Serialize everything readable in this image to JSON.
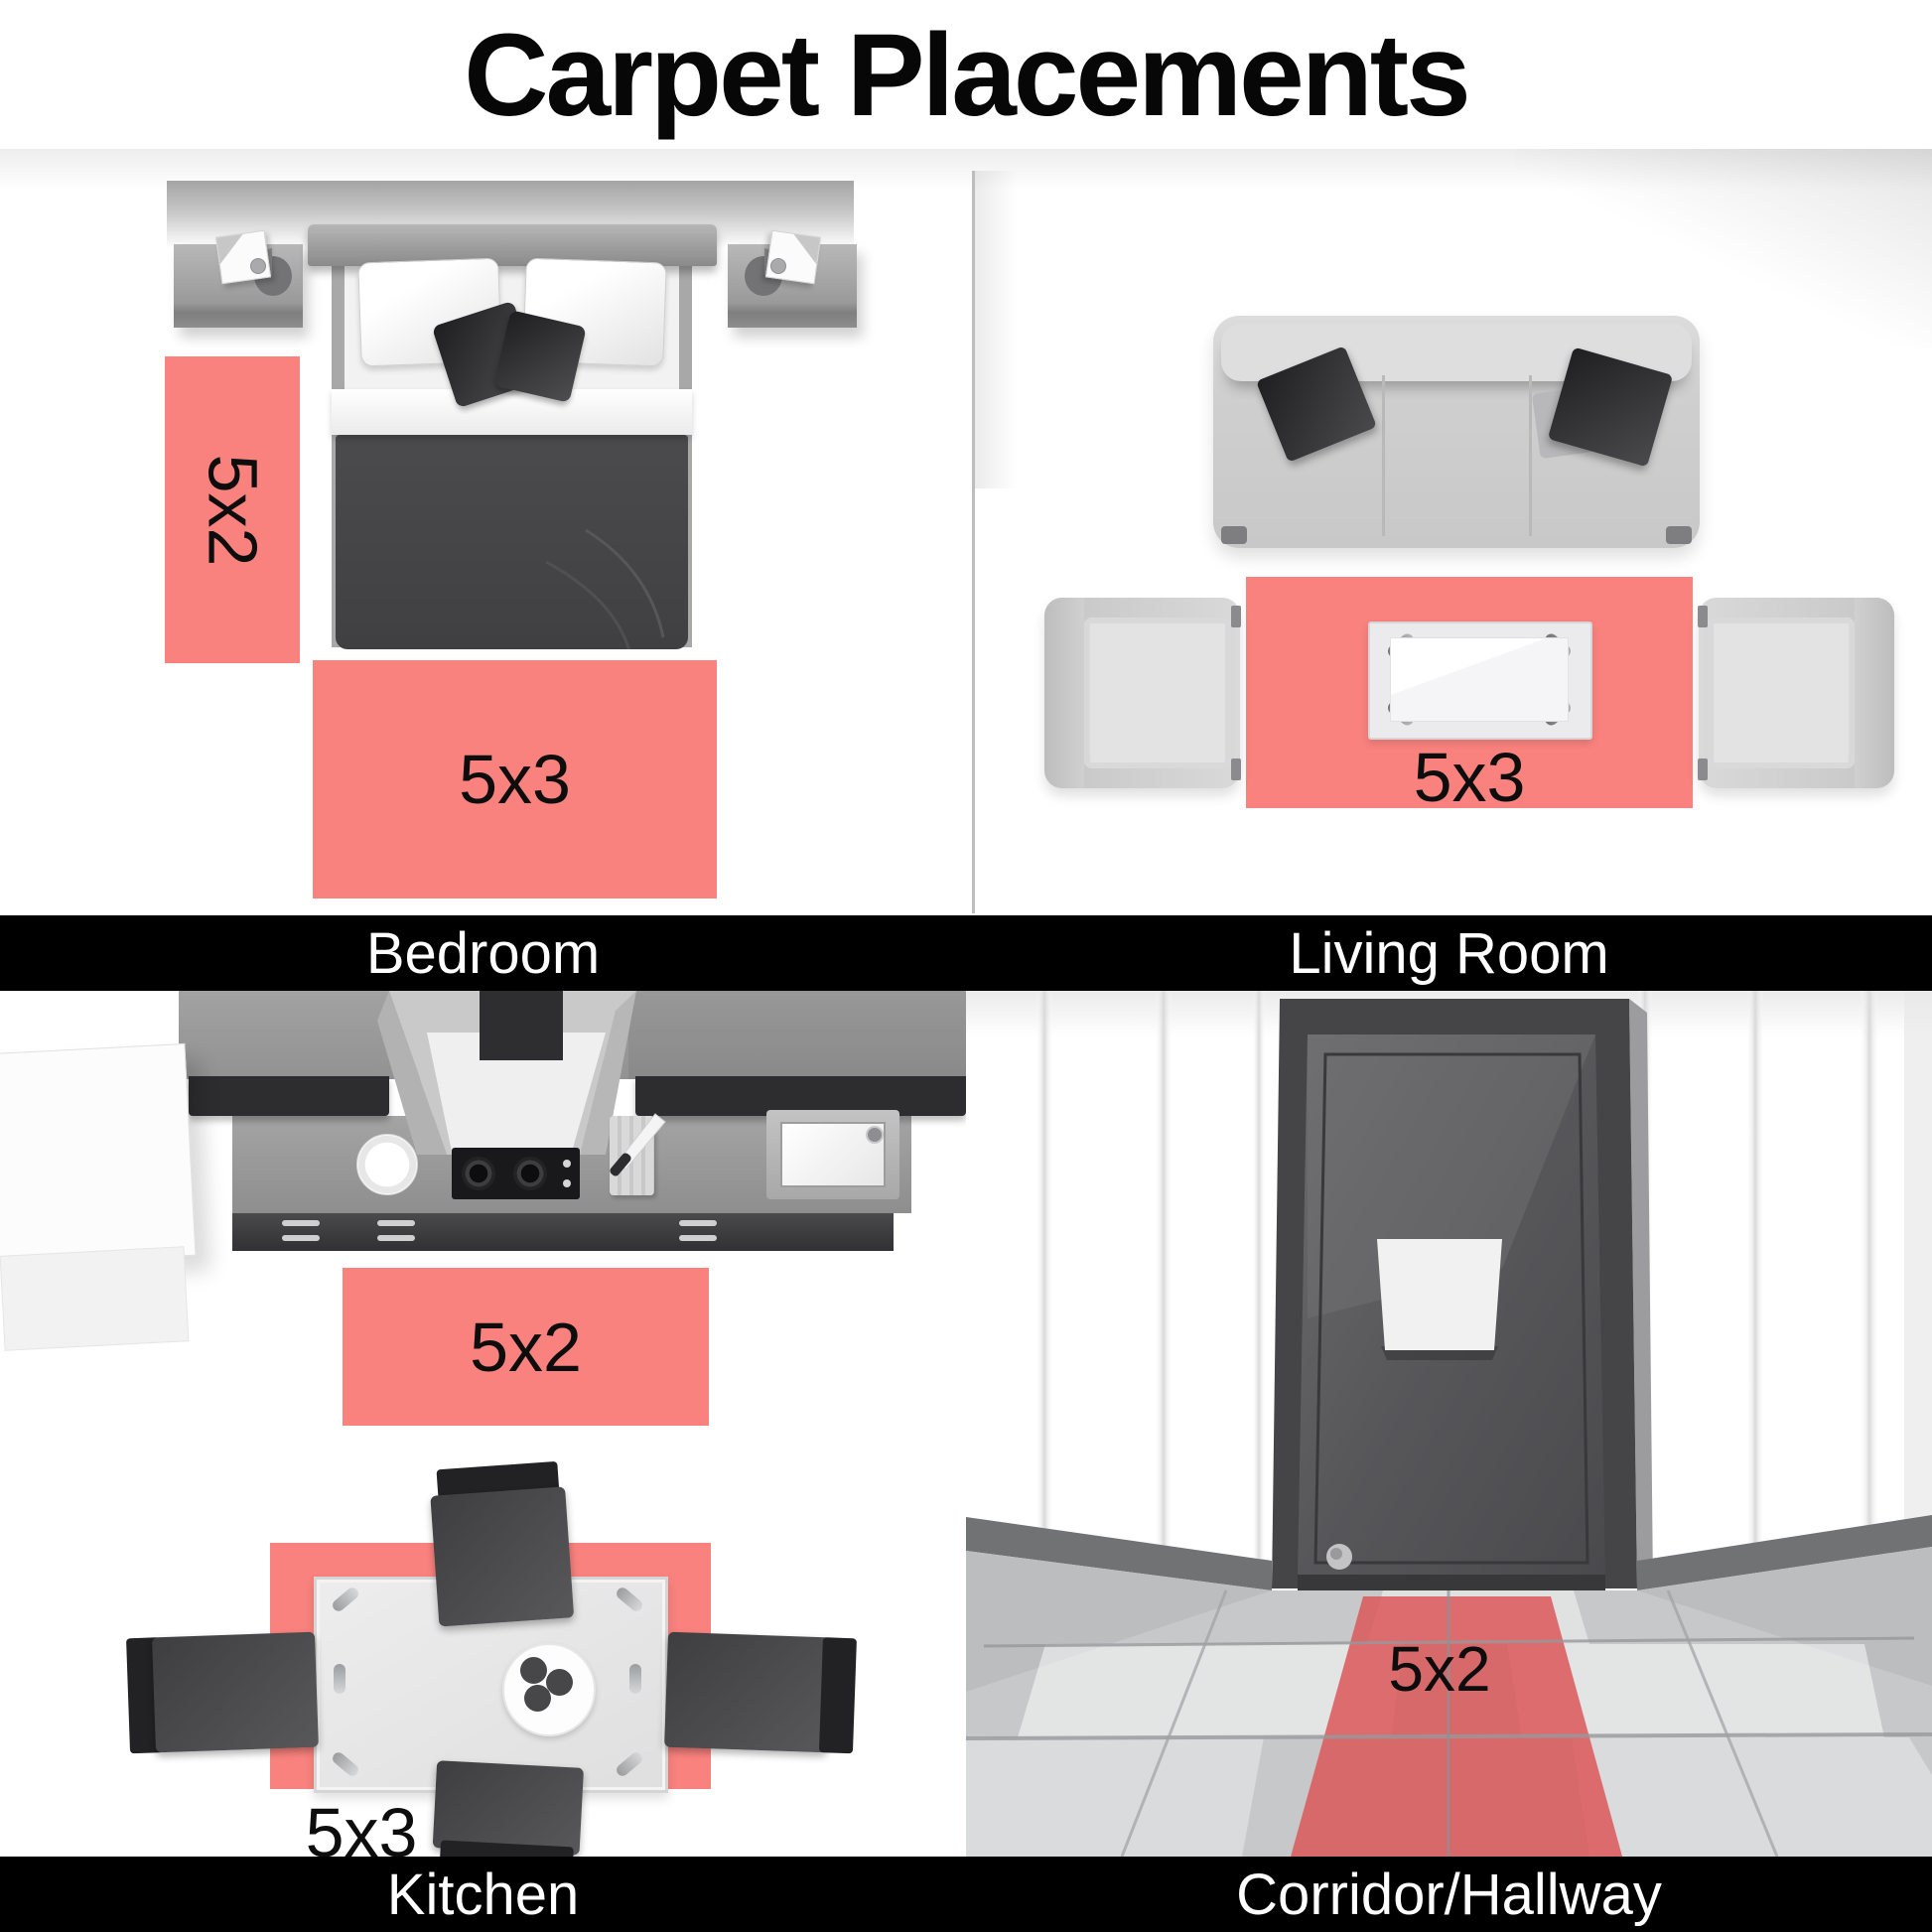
{
  "title": "Carpet Placements",
  "colors": {
    "rug_pink": "#F9827E",
    "runner_red": "#DB5B5D",
    "bar_background": "#000000",
    "bar_text": "#FFFFFF",
    "title_text": "#070707",
    "rug_label_text": "#0D0D0D"
  },
  "quadrants": [
    {
      "id": "bedroom",
      "label": "Bedroom",
      "rugs": [
        {
          "size": "5x2",
          "orientation": "vertical",
          "position": "left-of-bed"
        },
        {
          "size": "5x3",
          "orientation": "horizontal",
          "position": "foot-of-bed"
        }
      ]
    },
    {
      "id": "living-room",
      "label": "Living Room",
      "rugs": [
        {
          "size": "5x3",
          "orientation": "horizontal",
          "position": "under-coffee-table"
        }
      ]
    },
    {
      "id": "kitchen",
      "label": "Kitchen",
      "rugs": [
        {
          "size": "5x2",
          "orientation": "horizontal",
          "position": "in-front-of-counter"
        },
        {
          "size": "5x3",
          "orientation": "horizontal",
          "position": "under-dining-table"
        }
      ]
    },
    {
      "id": "corridor",
      "label": "Corridor/Hallway",
      "rugs": [
        {
          "size": "5x2",
          "orientation": "runner",
          "position": "along-hallway"
        }
      ]
    }
  ]
}
